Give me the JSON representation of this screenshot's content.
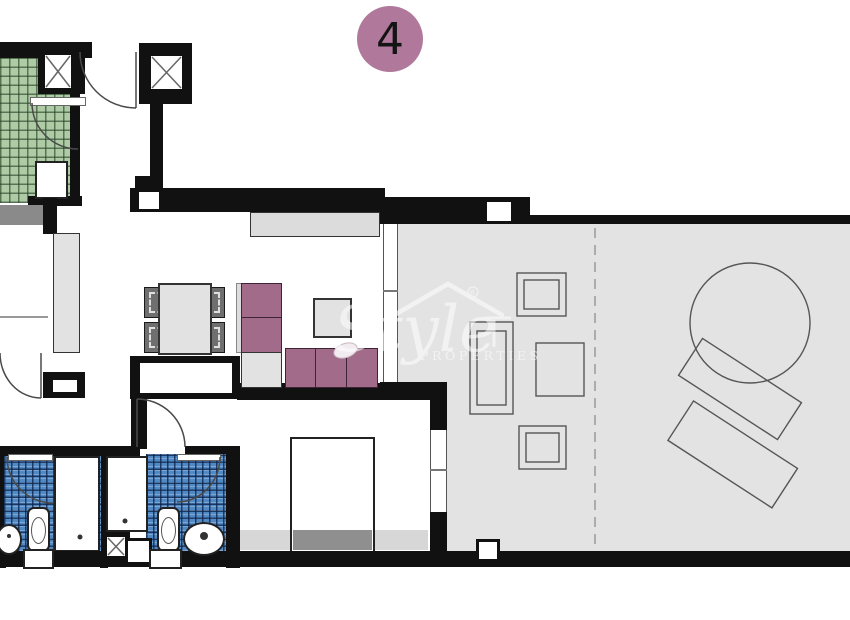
{
  "unit_badge": {
    "label": "4"
  },
  "watermark": {
    "script": "Style",
    "caps": "PROPERTIES",
    "registered": "R"
  },
  "colors": {
    "wall": "#111111",
    "terrace_floor": "#e3e3e3",
    "room_floor": "#ffffff",
    "tile_green": "#aecba6",
    "tile_green_line": "#3e5d3a",
    "tile_blue": "#5189c4",
    "tile_blue_line": "#17386b",
    "sofa_purple": "#a16b89",
    "furniture_gray": "#e2e2e2",
    "chair_dark_gray": "#6f6f6f",
    "bed_footer_gray": "#8f8f8f",
    "lintel_gray": "#8a8a8a",
    "badge_mauve": "#b0799c",
    "outline": "#4a4a4a",
    "watermark_white": "#ffffff"
  }
}
